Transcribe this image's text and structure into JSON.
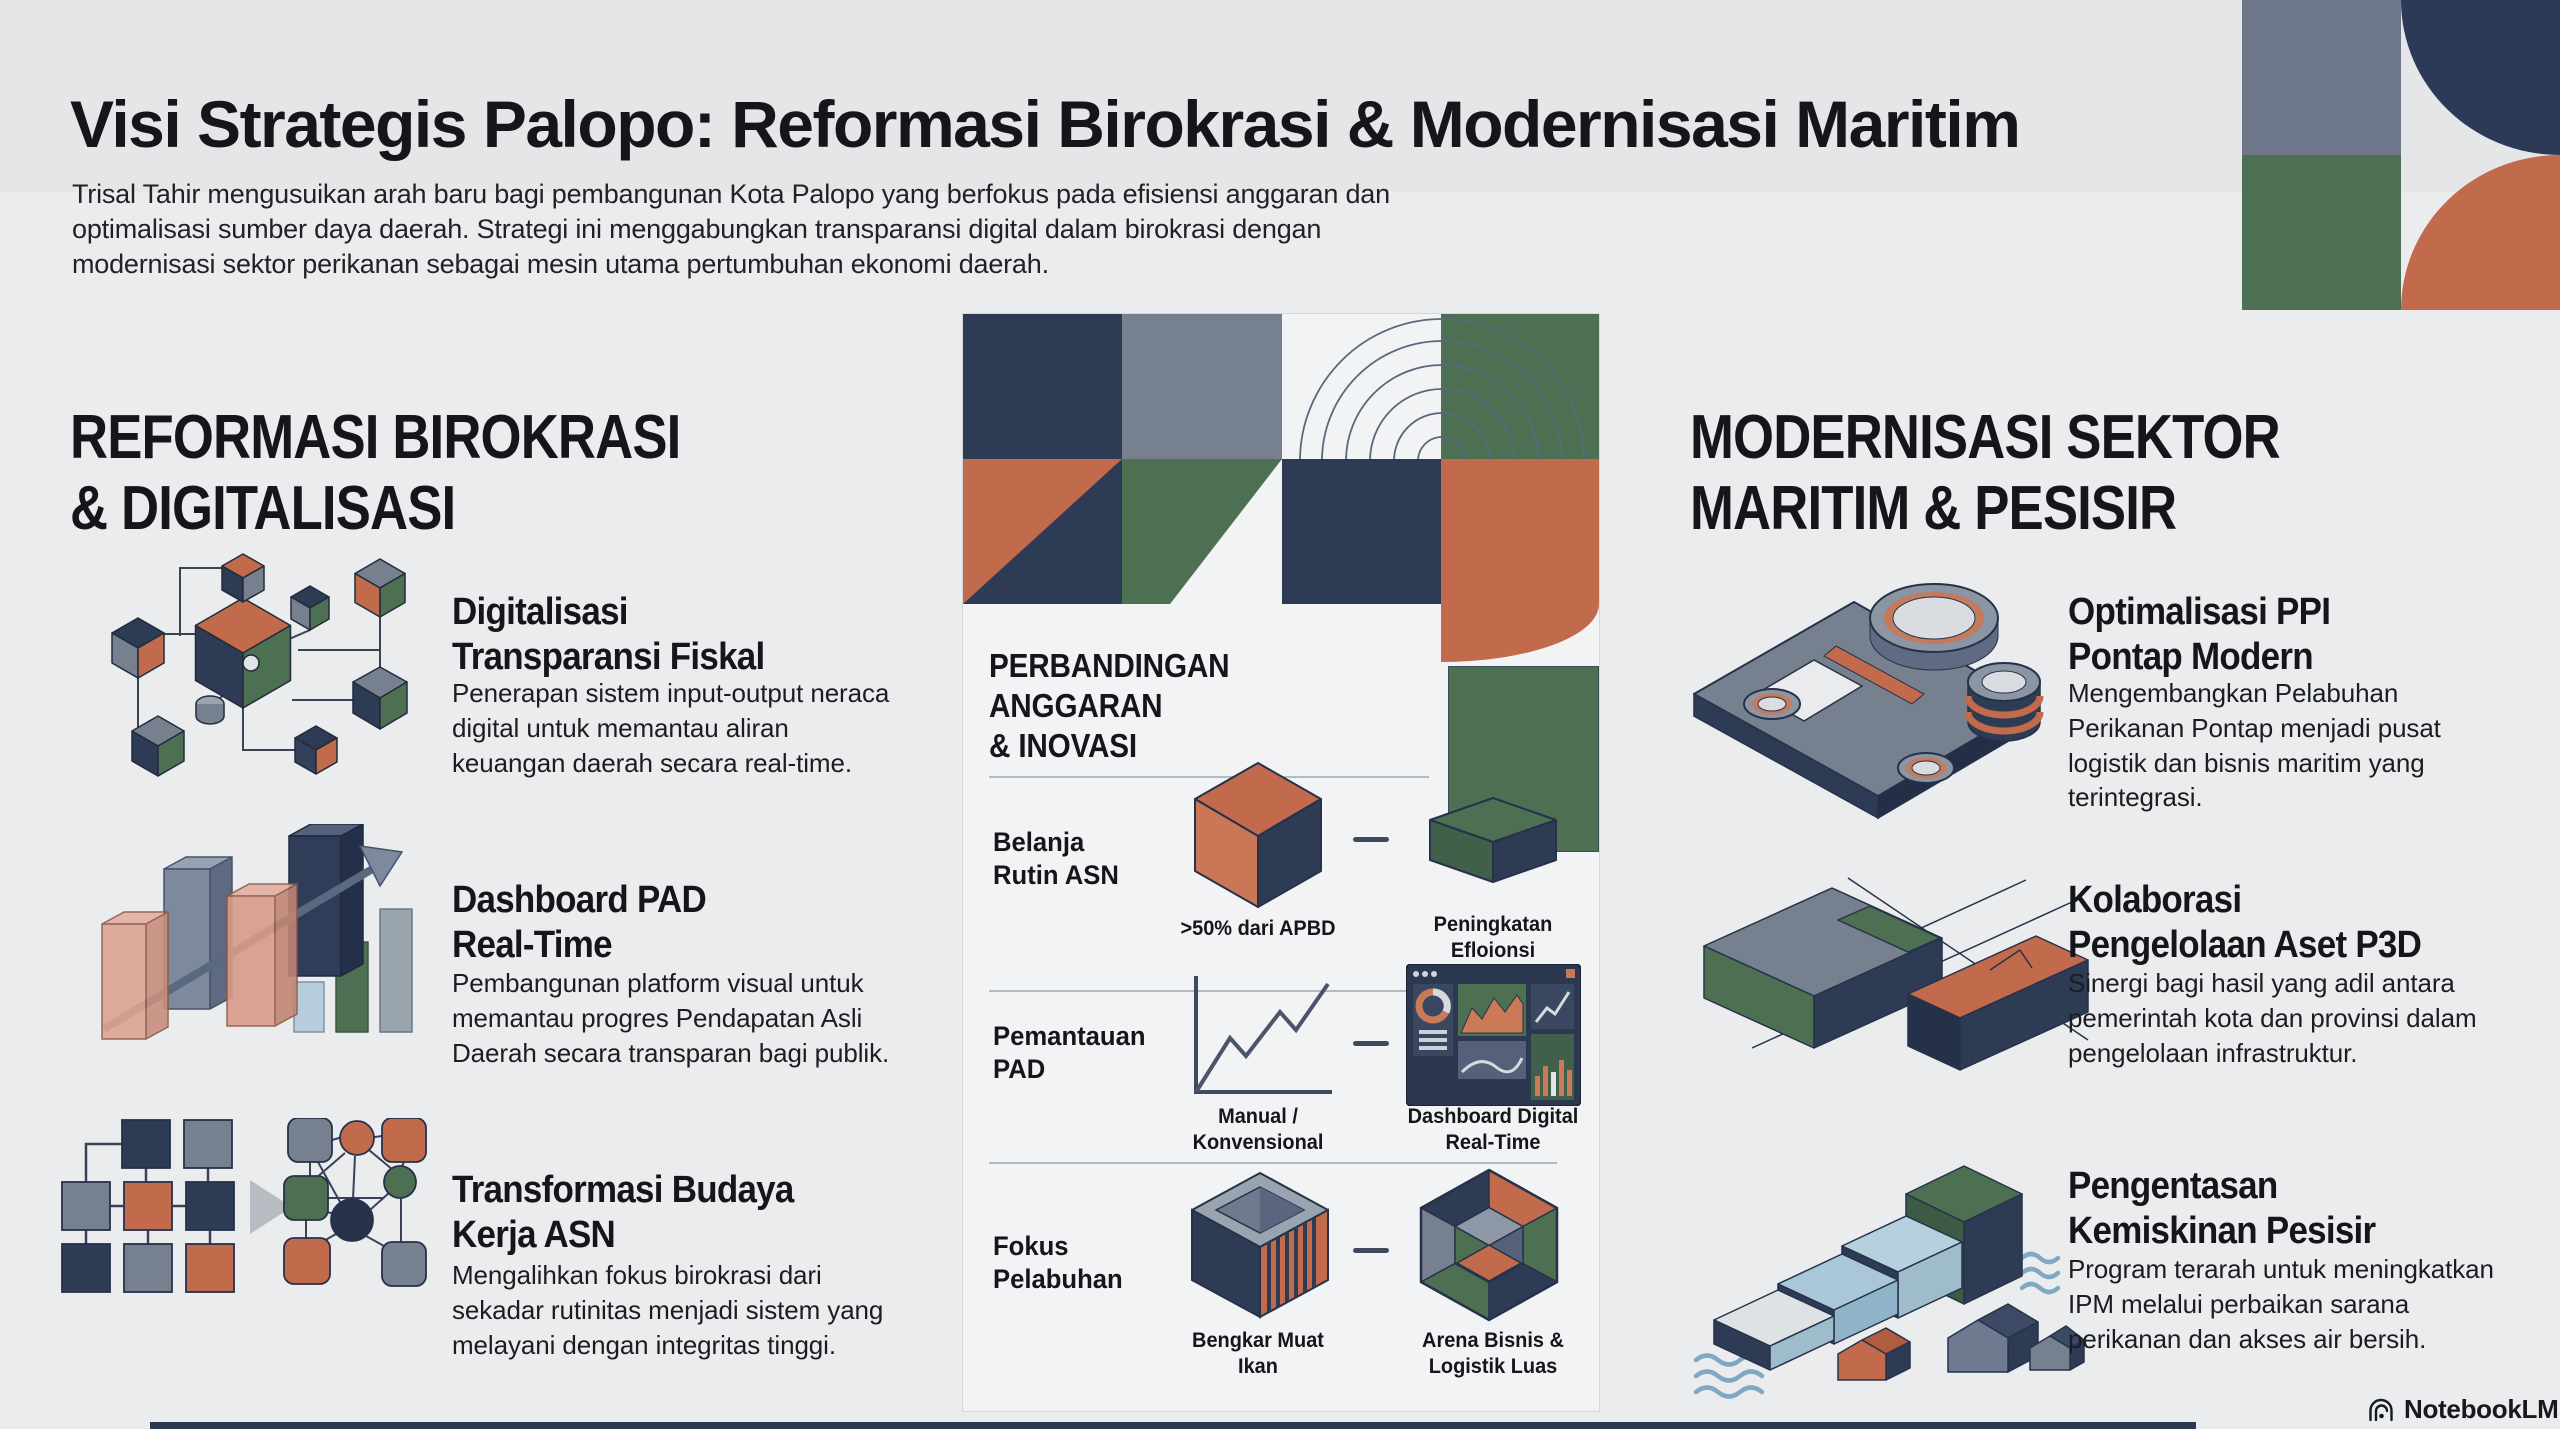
{
  "colors": {
    "navy": "#2e3b55",
    "slate": "#76808f",
    "green": "#4e7052",
    "terracotta": "#c16a4c",
    "light_blue": "#a9c7d9",
    "page_bg": "#eaecee",
    "panel_bg": "#f2f3f5",
    "footer_bar": "#2b3950"
  },
  "header": {
    "title": "Visi Strategis Palopo: Reformasi Birokrasi & Modernisasi Maritim",
    "subtitle": "Trisal Tahir mengusuikan arah baru bagi pembangunan Kota Palopo yang berfokus pada efisiensi anggaran dan\noptimalisasi sumber daya daerah. Strategi ini menggabungkan transparansi digital dalam birokrasi dengan\nmodernisasi sektor perikanan sebagai mesin utama pertumbuhan ekonomi daerah."
  },
  "left_section": {
    "heading": "REFORMASI BIROKRASI\n& DIGITALISASI",
    "items": [
      {
        "icon": "network-cubes-icon",
        "title": "Digitalisasi\nTransparansi Fiskal",
        "description": "Penerapan sistem input-output neraca\ndigital untuk memantau aliran\nkeuangan daerah secara real-time."
      },
      {
        "icon": "growth-bars-arrow-icon",
        "title": "Dashboard PAD\nReal-Time",
        "description": "Pembangunan platform visual untuk\nmemantau progres Pendapatan Asli\nDaerah secara transparan bagi publik."
      },
      {
        "icon": "org-chart-to-network-icon",
        "title": "Transformasi Budaya\nKerja ASN",
        "description": "Mengalihkan fokus birokrasi dari\nsekadar rutinitas menjadi sistem yang\nmelayani dengan integritas tinggi."
      }
    ]
  },
  "center_panel": {
    "heading": "PERBANDINGAN\nANGGARAN\n& INOVASI",
    "rows": [
      {
        "label": "Belanja\nRutin ASN",
        "left": {
          "icon": "iso-cube-icon",
          "caption": ">50% dari APBD"
        },
        "right": {
          "icon": "iso-slab-icon",
          "caption": "Peningkatan\nEfloionsi"
        }
      },
      {
        "label": "Pemantauan\nPAD",
        "left": {
          "icon": "line-chart-icon",
          "caption": "Manual /\nKonvensional"
        },
        "right": {
          "icon": "dashboard-icon",
          "caption": "Dashboard Digital\nReal-Time"
        }
      },
      {
        "label": "Fokus\nPelabuhan",
        "left": {
          "icon": "cargo-container-icon",
          "caption": "Bengkar Muat\nIkan"
        },
        "right": {
          "icon": "iso-hexagon-icon",
          "caption": "Arena Bisnis &\nLogistik Luas"
        }
      }
    ]
  },
  "right_section": {
    "heading": "MODERNISASI SEKTOR\nMARITIM & PESISIR",
    "items": [
      {
        "icon": "port-machinery-icon",
        "title": "Optimalisasi PPI\nPontap Modern",
        "description": "Mengembangkan Pelabuhan\nPerikanan Pontap menjadi pusat\nlogistik dan bisnis maritim yang\nterintegrasi."
      },
      {
        "icon": "land-parcels-icon",
        "title": "Kolaborasi\nPengelolaan Aset P3D",
        "description": "Sinergi bagi hasil yang adil antara\npemerintah kota dan provinsi dalam\npengelolaan infrastruktur."
      },
      {
        "icon": "coastal-steps-houses-icon",
        "title": "Pengentasan\nKemiskinan Pesisir",
        "description": "Program terarah untuk meningkatkan\nIPM melalui perbaikan sarana\nperikanan dan akses air bersih."
      }
    ]
  },
  "footer": {
    "brand": "NotebookLM"
  }
}
